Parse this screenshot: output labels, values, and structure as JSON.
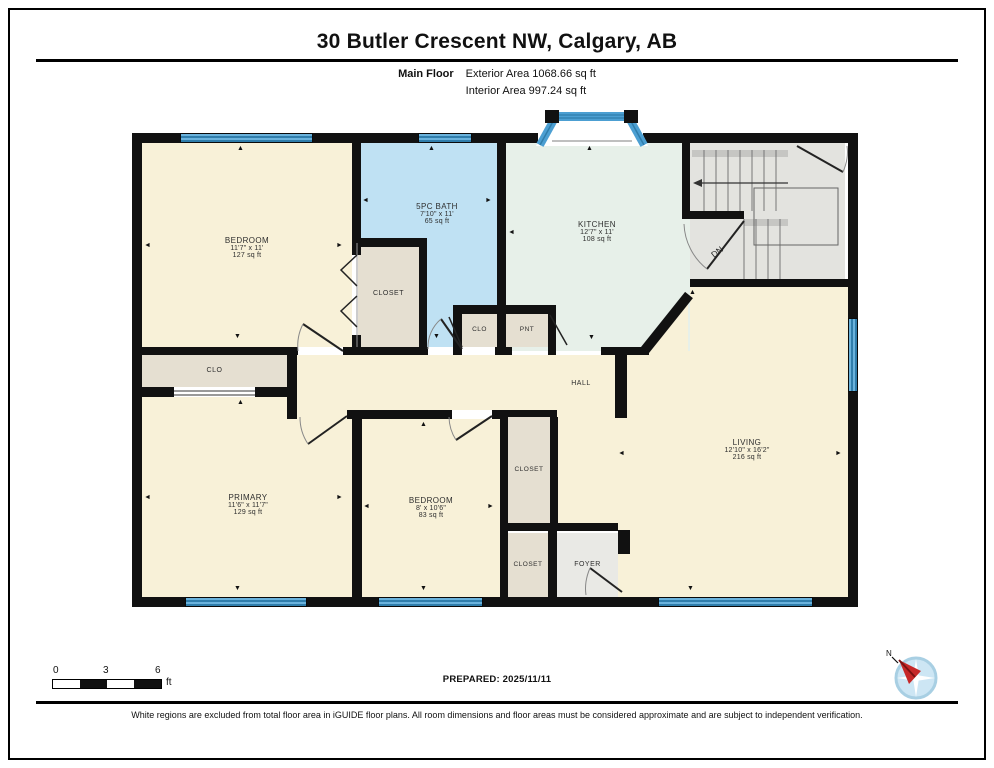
{
  "header": {
    "title": "30 Butler Crescent NW, Calgary, AB",
    "floor_label": "Main Floor",
    "exterior_area": "Exterior Area 1068.66 sq ft",
    "interior_area": "Interior Area 997.24 sq ft"
  },
  "rooms": {
    "bedroom1": {
      "name": "BEDROOM",
      "dims": "11'7\" x 11'",
      "area": "127 sq ft"
    },
    "bath": {
      "name": "5PC BATH",
      "dims": "7'10\" x 11'",
      "area": "65 sq ft"
    },
    "kitchen": {
      "name": "KITCHEN",
      "dims": "12'7\" x 11'",
      "area": "108 sq ft"
    },
    "living": {
      "name": "LIVING",
      "dims": "12'10\" x 16'2\"",
      "area": "216 sq ft"
    },
    "primary": {
      "name": "PRIMARY",
      "dims": "11'6\" x 11'7\"",
      "area": "129 sq ft"
    },
    "bedroom2": {
      "name": "BEDROOM",
      "dims": "8' x 10'6\"",
      "area": "83 sq ft"
    },
    "closet_bedroom1": {
      "name": "CLOSET"
    },
    "clo_hall": {
      "name": "CLO"
    },
    "clo_small": {
      "name": "CLO"
    },
    "pantry": {
      "name": "PNT"
    },
    "hall": {
      "name": "HALL"
    },
    "closet_mid": {
      "name": "CLOSET"
    },
    "closet_bottom": {
      "name": "CLOSET"
    },
    "foyer": {
      "name": "FOYER"
    },
    "stairs": {
      "label": "DN"
    }
  },
  "icons": {
    "arrow_up": "▲",
    "arrow_down": "▼",
    "arrow_left": "◄",
    "arrow_right": "►"
  },
  "scale": {
    "labels": [
      "0",
      "3",
      "6"
    ],
    "unit": "ft"
  },
  "compass": {
    "label": "N"
  },
  "footer": {
    "prepared": "PREPARED: 2025/11/11",
    "disclaimer": "White regions are excluded from total floor area in iGUIDE floor plans. All room dimensions and floor areas must be considered approximate and are subject to independent verification."
  },
  "colors": {
    "wall": "#111111",
    "window_blue": "#4c9fd2",
    "room_cream": "#f8f1d8",
    "bath_blue": "#bfe1f3",
    "kitchen_mint": "#e7f0e9",
    "closet_beige": "#e5dfd1",
    "stair_gray": "#e3e3df",
    "compass_red": "#c62828"
  }
}
